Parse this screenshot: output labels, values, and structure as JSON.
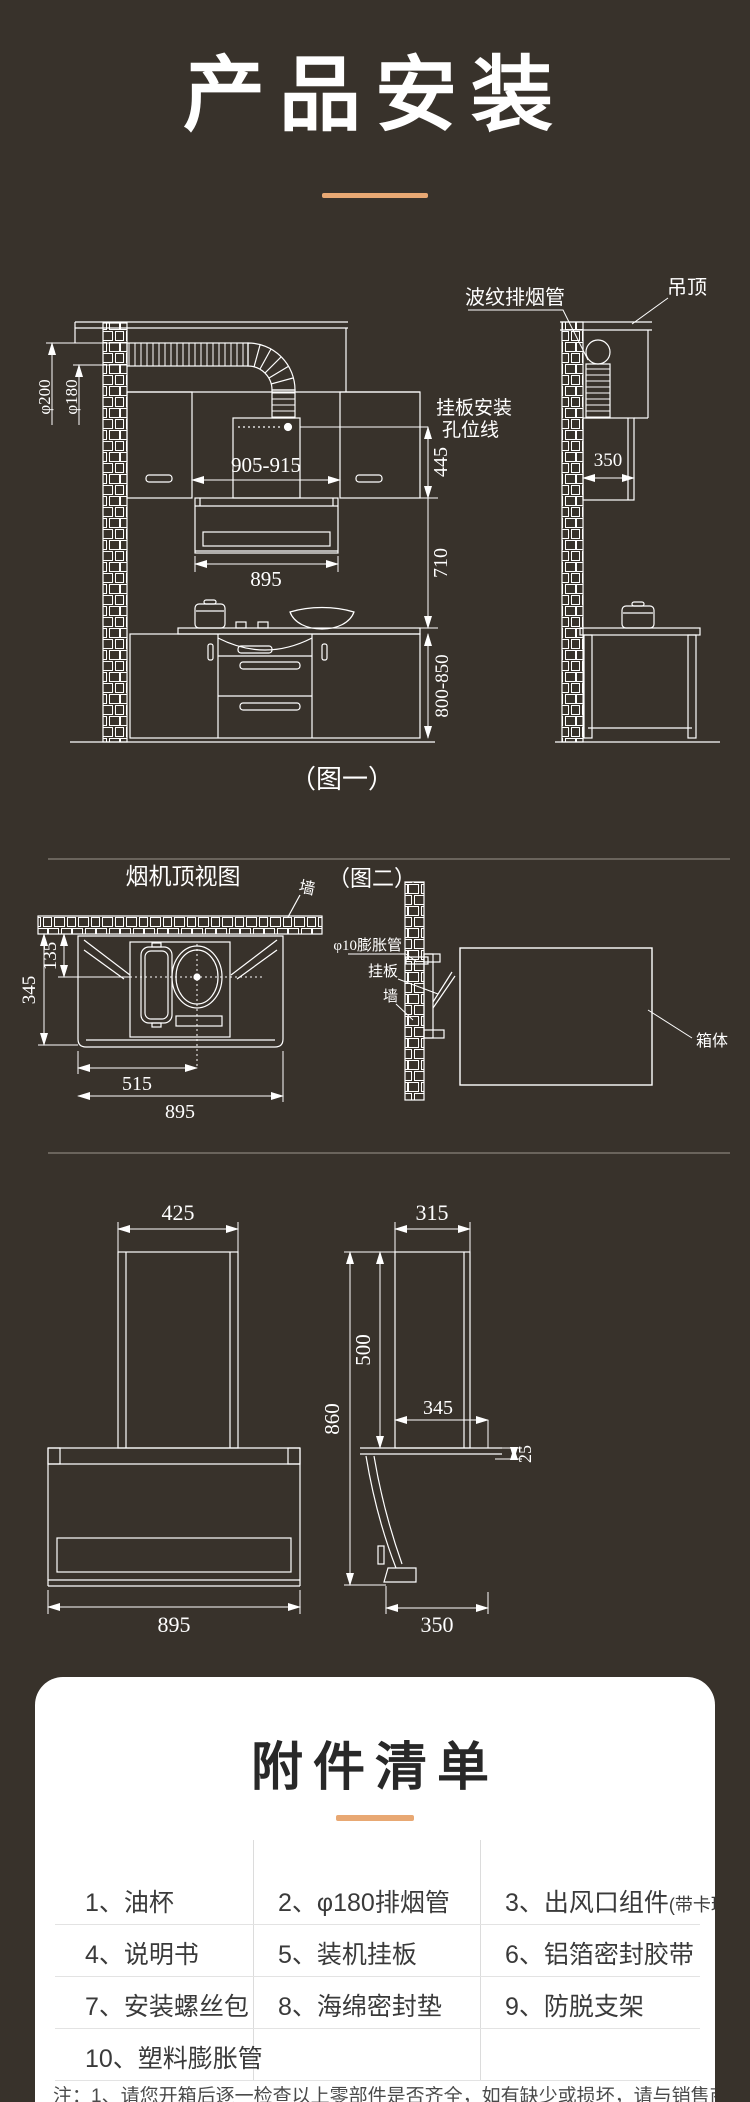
{
  "page_title": "产品安装",
  "fig1": {
    "caption": "（图一）",
    "labels": {
      "corrugated_pipe": "波纹排烟管",
      "ceiling": "吊顶",
      "hang_plate_line_1": "挂板安装",
      "hang_plate_line_2": "孔位线"
    },
    "dims": {
      "phi200": "φ200",
      "phi180": "φ180",
      "hole_span": "905-915",
      "d445": "445",
      "d350": "350",
      "d895": "895",
      "d710": "710",
      "d800_850": "800-850"
    }
  },
  "fig2": {
    "title": "烟机顶视图",
    "caption": "（图二）",
    "labels": {
      "wall_top": "墙",
      "expansion_tube": "φ10膨胀管",
      "hang_plate": "挂板",
      "wall_side": "墙",
      "box_body": "箱体"
    },
    "dims": {
      "d135": "135",
      "d345": "345",
      "d515": "515",
      "d895": "895"
    }
  },
  "fig3": {
    "dims": {
      "front_width_top": "425",
      "front_width_bottom": "895",
      "side_width_top": "315",
      "side_height_total": "860",
      "side_height_upper": "500",
      "side_depth": "345",
      "side_offset": "25",
      "side_width_bottom": "350"
    }
  },
  "accessories": {
    "title": "附件清单",
    "rows": [
      {
        "c1": "1、油杯",
        "c2": "2、φ180排烟管",
        "c3": "3、出风口组件",
        "c3s": "(带卡环)"
      },
      {
        "c1": "4、说明书",
        "c2": "5、装机挂板",
        "c3": "6、铝箔密封胶带",
        "c3s": ""
      },
      {
        "c1": "7、安装螺丝包",
        "c2": "8、海绵密封垫",
        "c3": "9、防脱支架",
        "c3s": ""
      },
      {
        "c1": "10、塑料膨胀管",
        "c2": "",
        "c3": "",
        "c3s": ""
      }
    ]
  },
  "note": "注：1、请您开箱后逐一检查以上零部件是否齐全，如有缺少或损坏，请与销售商联系",
  "colors": {
    "background": "#38322B",
    "accent": "#E8A873",
    "line_art": "#FFFFFF",
    "card_bg": "#FFFFFF"
  }
}
